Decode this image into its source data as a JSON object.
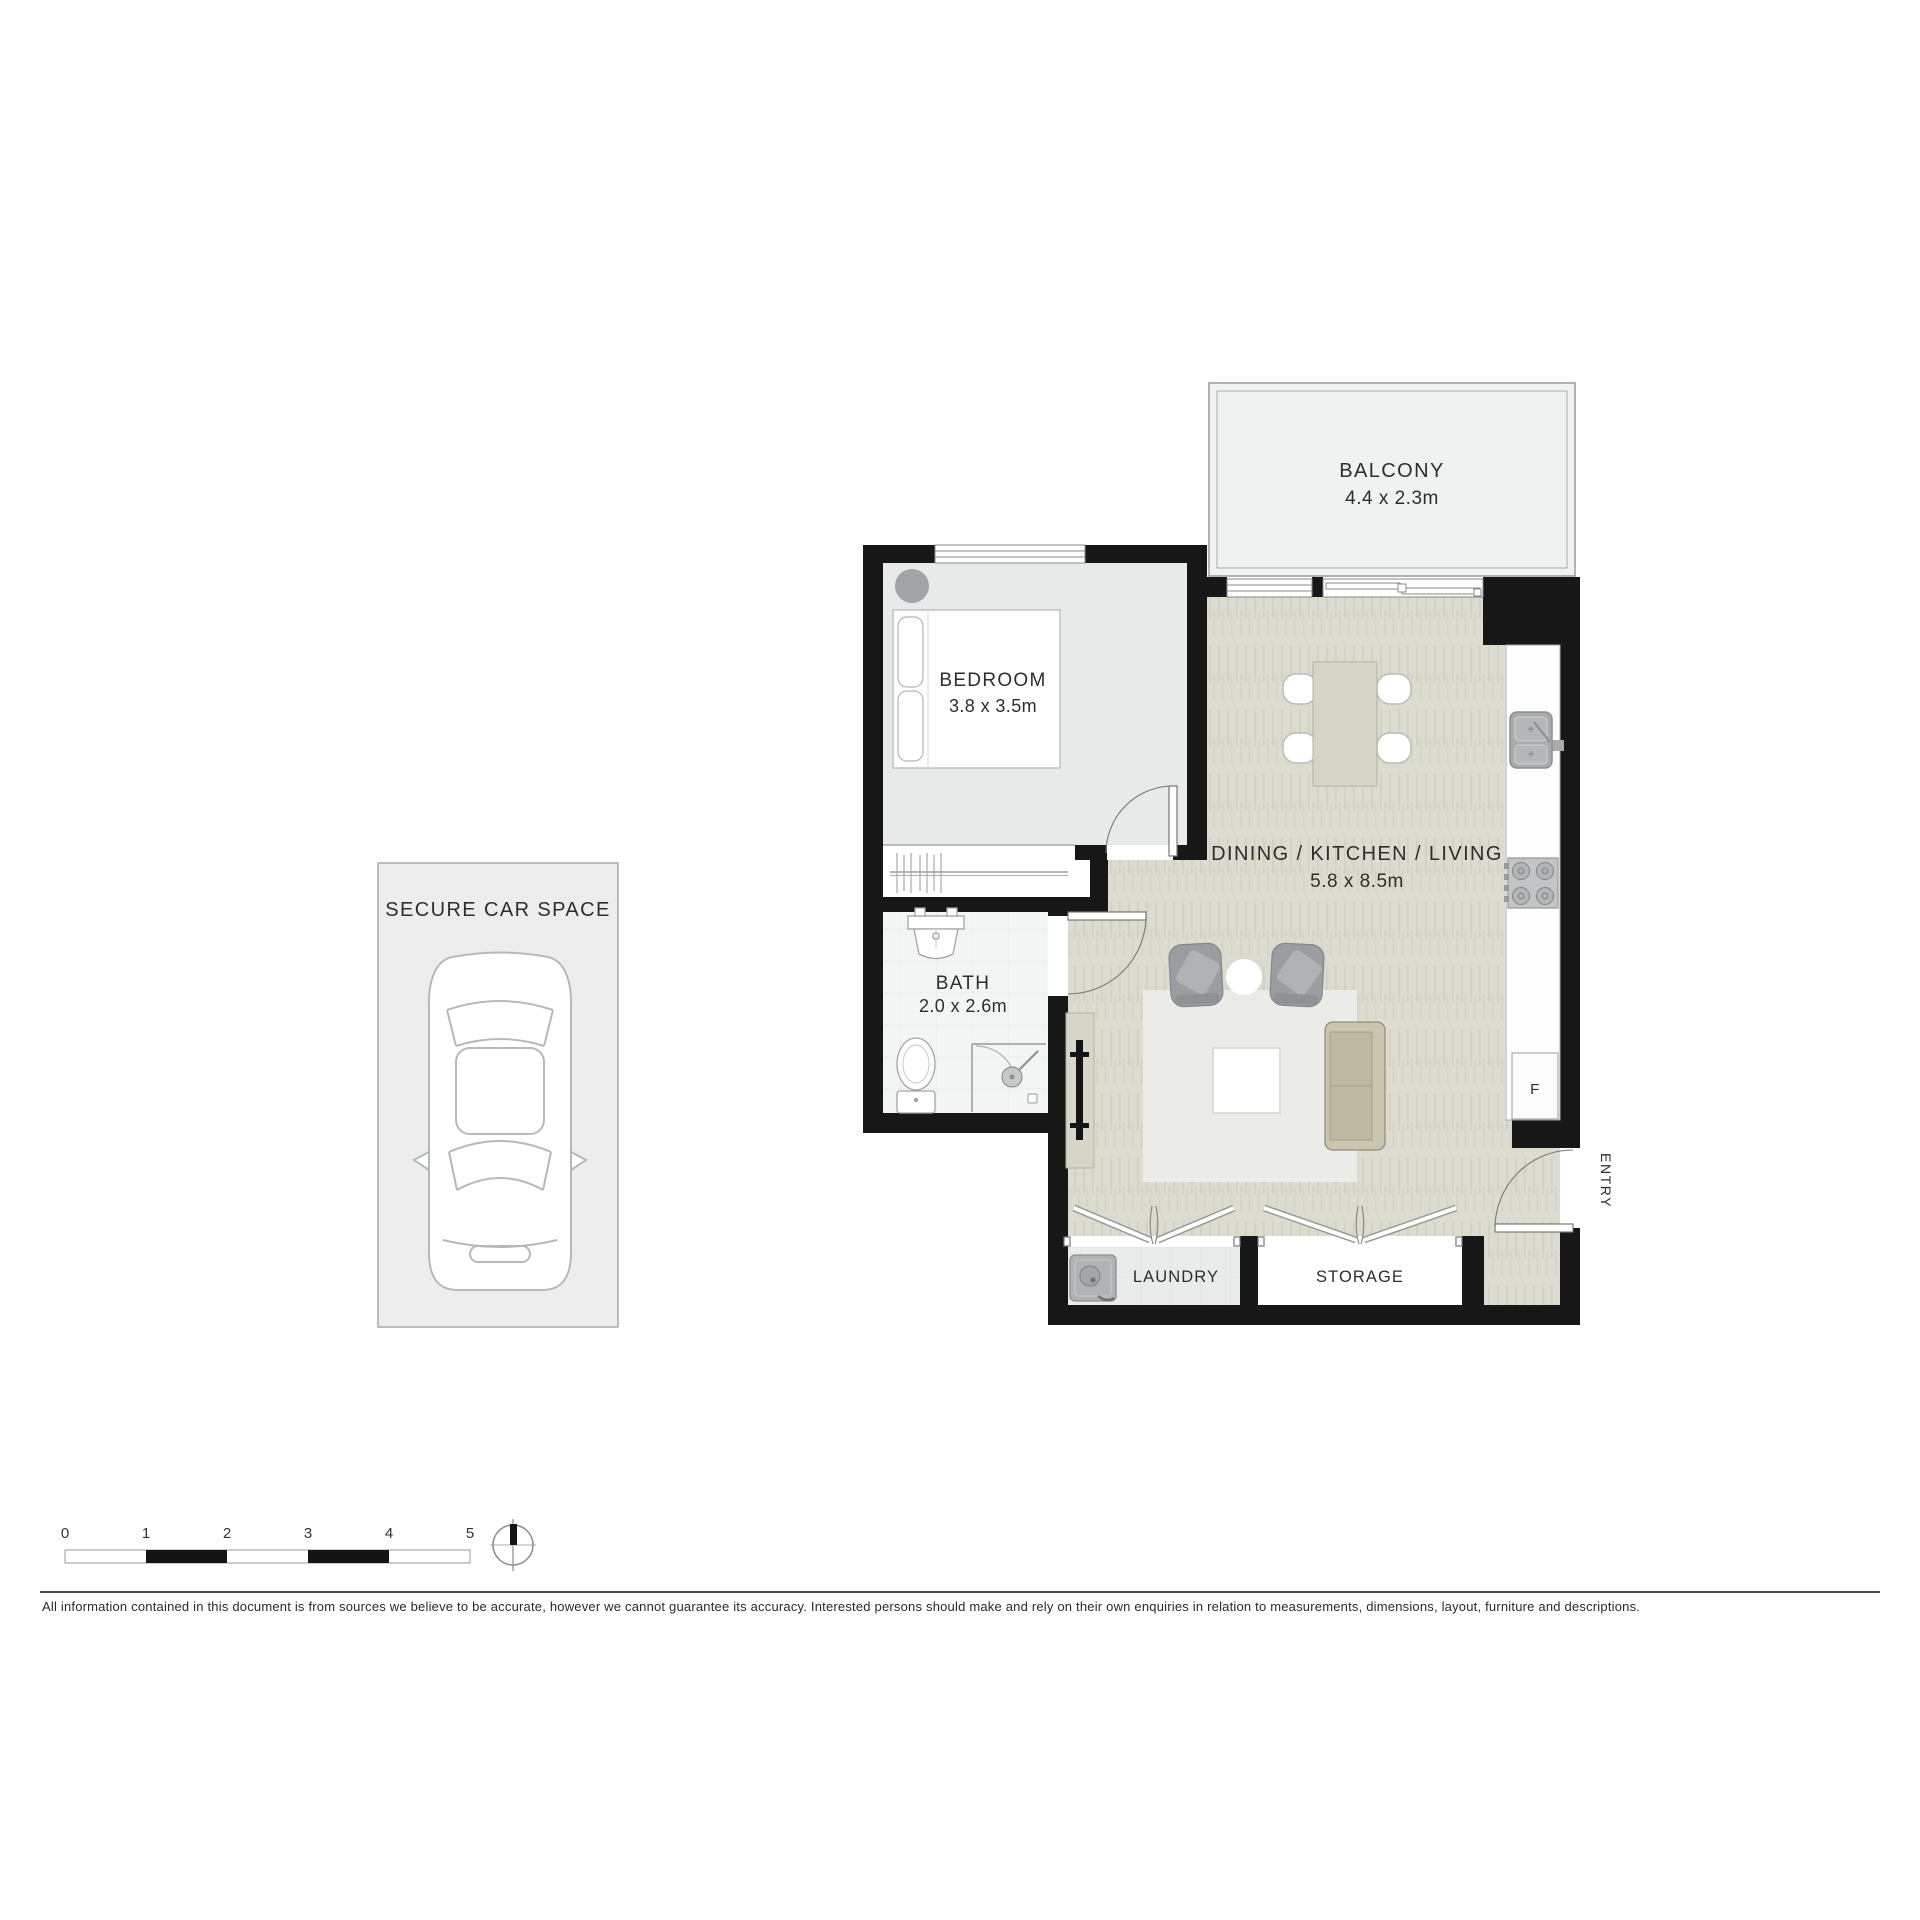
{
  "plan": {
    "balcony": {
      "label": "BALCONY",
      "dim": "4.4 x 2.3m"
    },
    "bedroom": {
      "label": "BEDROOM",
      "dim": "3.8 x 3.5m"
    },
    "living": {
      "label": "DINING / KITCHEN / LIVING",
      "dim": "5.8 x 8.5m"
    },
    "bath": {
      "label": "BATH",
      "dim": "2.0 x 2.6m"
    },
    "laundry": {
      "label": "LAUNDRY"
    },
    "storage": {
      "label": "STORAGE"
    },
    "entry": {
      "label": "ENTRY"
    },
    "fridge": {
      "label": "F"
    },
    "car_space": {
      "label": "SECURE CAR SPACE"
    }
  },
  "scale_bar": {
    "ticks": [
      "0",
      "1",
      "2",
      "3",
      "4",
      "5"
    ]
  },
  "disclaimer": "All information contained in this document is from sources we believe to be accurate, however we cannot guarantee its accuracy. Interested persons should make and rely on their own enquiries in relation to measurements, dimensions, layout, furniture and descriptions.",
  "colors": {
    "wall": "#171717",
    "floor_living": "#dbdccf",
    "floor_bedroom": "#e8e9e9",
    "floor_bath": "#f3f4f4",
    "floor_balcony": "#f0f1f1",
    "floor_laundry": "#eaeceb",
    "floor_carspace": "#ededee",
    "rug": "#ebebe8",
    "furniture_gray": "#9b9ea1",
    "sofa_tan": "#c9c5ae",
    "text": "#2d2d2d"
  }
}
